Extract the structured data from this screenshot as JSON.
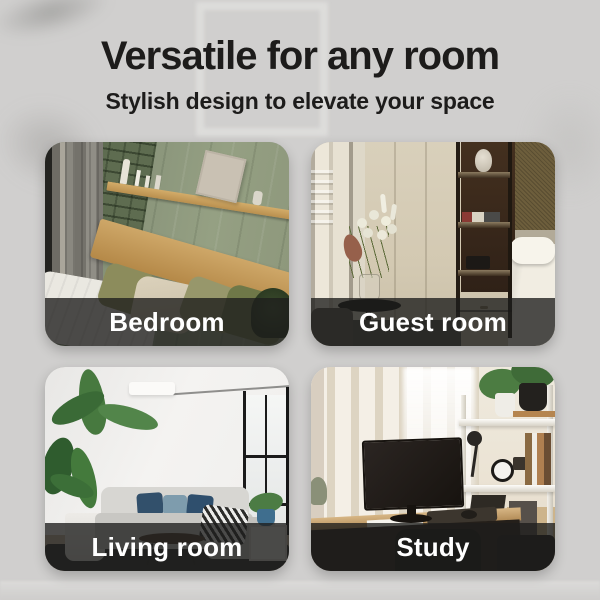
{
  "header": {
    "title": "Versatile for any room",
    "subtitle": "Stylish design to elevate your space"
  },
  "cards": [
    {
      "id": "bedroom",
      "label": "Bedroom"
    },
    {
      "id": "guest-room",
      "label": "Guest room"
    },
    {
      "id": "living-room",
      "label": "Living room"
    },
    {
      "id": "study",
      "label": "Study"
    }
  ],
  "colors": {
    "background": "#d0cfce",
    "title_text": "#1d1c1b",
    "label_bar": "rgba(30,29,28,0.78)",
    "label_text": "#ffffff"
  }
}
